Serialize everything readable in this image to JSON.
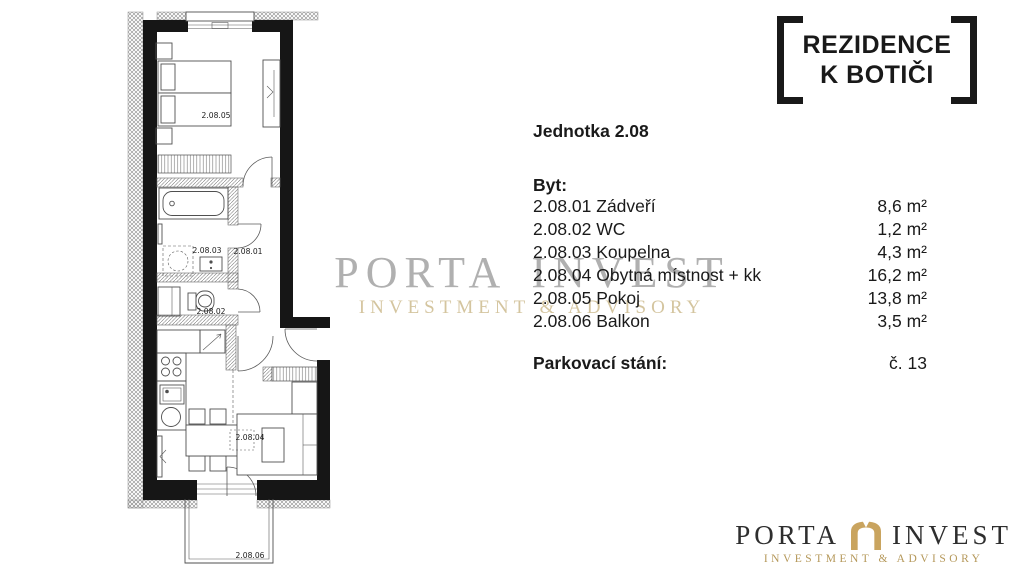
{
  "logo_top": {
    "line1": "REZIDENCE",
    "line2": "K BOTIČI"
  },
  "unit": {
    "title": "Jednotka 2.08",
    "section_label": "Byt:",
    "rooms": [
      {
        "label": "2.08.01 Zádveří",
        "area": "8,6 m²"
      },
      {
        "label": "2.08.02 WC",
        "area": "1,2 m²"
      },
      {
        "label": "2.08.03 Koupelna",
        "area": "4,3 m²"
      },
      {
        "label": "2.08.04 Obytná místnost + kk",
        "area": "16,2 m²"
      },
      {
        "label": "2.08.05 Pokoj",
        "area": "13,8 m²"
      },
      {
        "label": "2.08.06 Balkon",
        "area": "3,5 m²"
      }
    ],
    "parking_label": "Parkovací stání:",
    "parking_value": "č. 13"
  },
  "plan": {
    "labels": {
      "hall": "2.08.01",
      "wc": "2.08.02",
      "bathroom": "2.08.03",
      "living_room": "2.08.04",
      "bedroom": "2.08.05",
      "balcony": "2.08.06"
    }
  },
  "watermark": {
    "word1": "PORTA",
    "word2": "INVEST",
    "subtitle": "INVESTMENT & ADVISORY"
  },
  "logo_bottom": {
    "word1": "PORTA",
    "word2": "INVEST",
    "subtitle": "INVESTMENT & ADVISORY"
  },
  "colors": {
    "gold": "#c9a45f",
    "watermark_gold": "#ddc99c",
    "ink": "#1a1a1a",
    "watermark_gray": "#a3a3a3"
  }
}
